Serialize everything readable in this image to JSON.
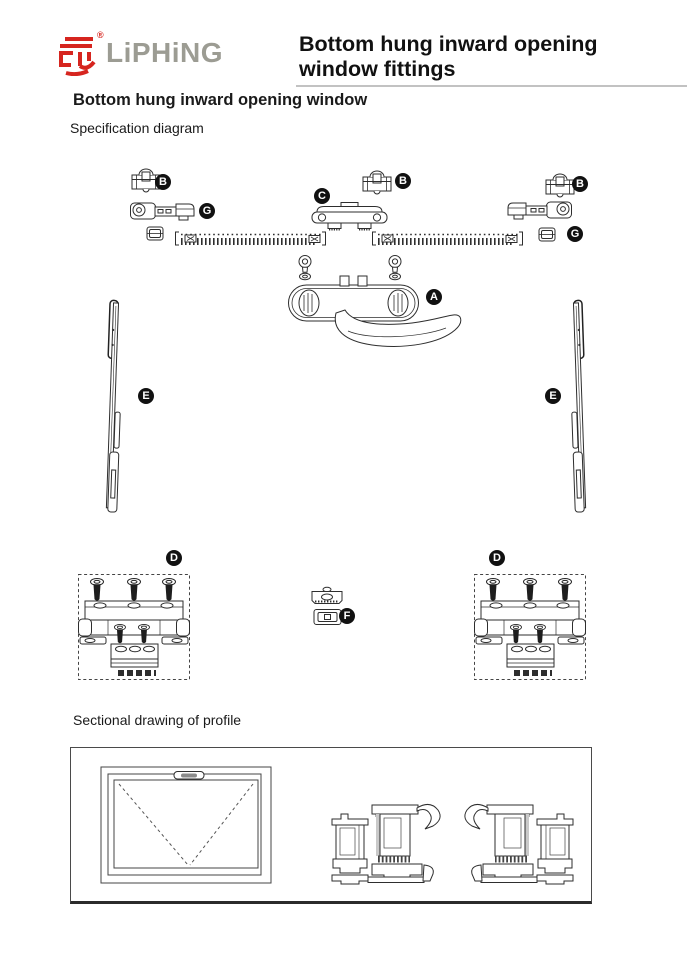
{
  "header": {
    "brand": "LiPHiNG",
    "registered": "®",
    "title_lines": [
      "Bottom hung inward opening",
      "window fittings"
    ]
  },
  "sections": {
    "diagram_heading": "Bottom hung inward opening window",
    "diagram_sublabel": "Specification diagram",
    "profile_label": "Sectional drawing of profile"
  },
  "diagram": {
    "part_labels": [
      {
        "letter": "B",
        "x": 163,
        "y": 182
      },
      {
        "letter": "C",
        "x": 322,
        "y": 196
      },
      {
        "letter": "B",
        "x": 403,
        "y": 181
      },
      {
        "letter": "B",
        "x": 580,
        "y": 184
      },
      {
        "letter": "G",
        "x": 207,
        "y": 211
      },
      {
        "letter": "G",
        "x": 575,
        "y": 234
      },
      {
        "letter": "A",
        "x": 434,
        "y": 297
      },
      {
        "letter": "E",
        "x": 146,
        "y": 396
      },
      {
        "letter": "E",
        "x": 553,
        "y": 396
      },
      {
        "letter": "D",
        "x": 174,
        "y": 558
      },
      {
        "letter": "D",
        "x": 497,
        "y": 558
      },
      {
        "letter": "F",
        "x": 347,
        "y": 616
      }
    ]
  },
  "colors": {
    "brand_red": "#d6251f",
    "brand_gray": "#9c9c93",
    "label_bg": "#111111",
    "line_color": "#2e2e2e"
  }
}
